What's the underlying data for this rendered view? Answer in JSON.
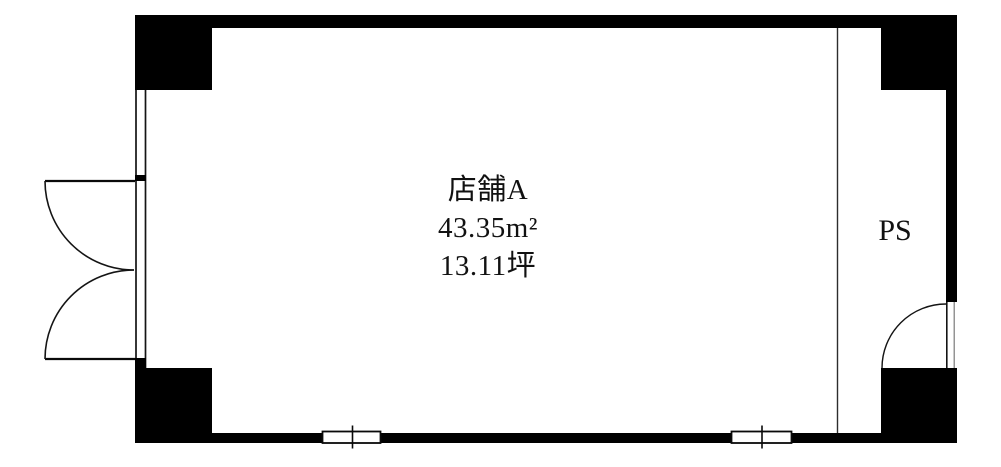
{
  "unit": {
    "name": "店舗A",
    "area_sqm": "43.35m²",
    "area_tsubo": "13.11坪"
  },
  "labels": {
    "pipe_space": "PS"
  },
  "colors": {
    "wall": "#000000",
    "line": "#141414",
    "partition_line": "#2d2d2d",
    "background": "#ffffff"
  }
}
